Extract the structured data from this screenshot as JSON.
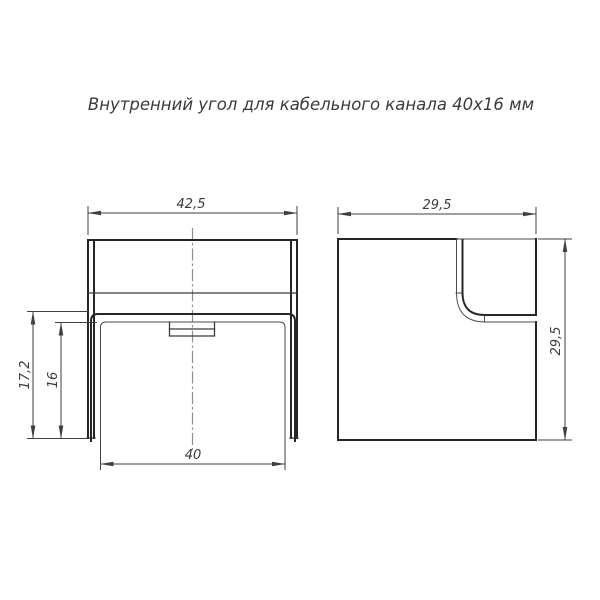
{
  "drawing": {
    "title": "Внутренний угол для кабельного канала 40x16 мм",
    "front_view": {
      "outer_width": "42,5",
      "inner_width": "40",
      "outer_height": "17,2",
      "inner_height": "16"
    },
    "side_view": {
      "width": "29,5",
      "height": "29,5"
    }
  }
}
